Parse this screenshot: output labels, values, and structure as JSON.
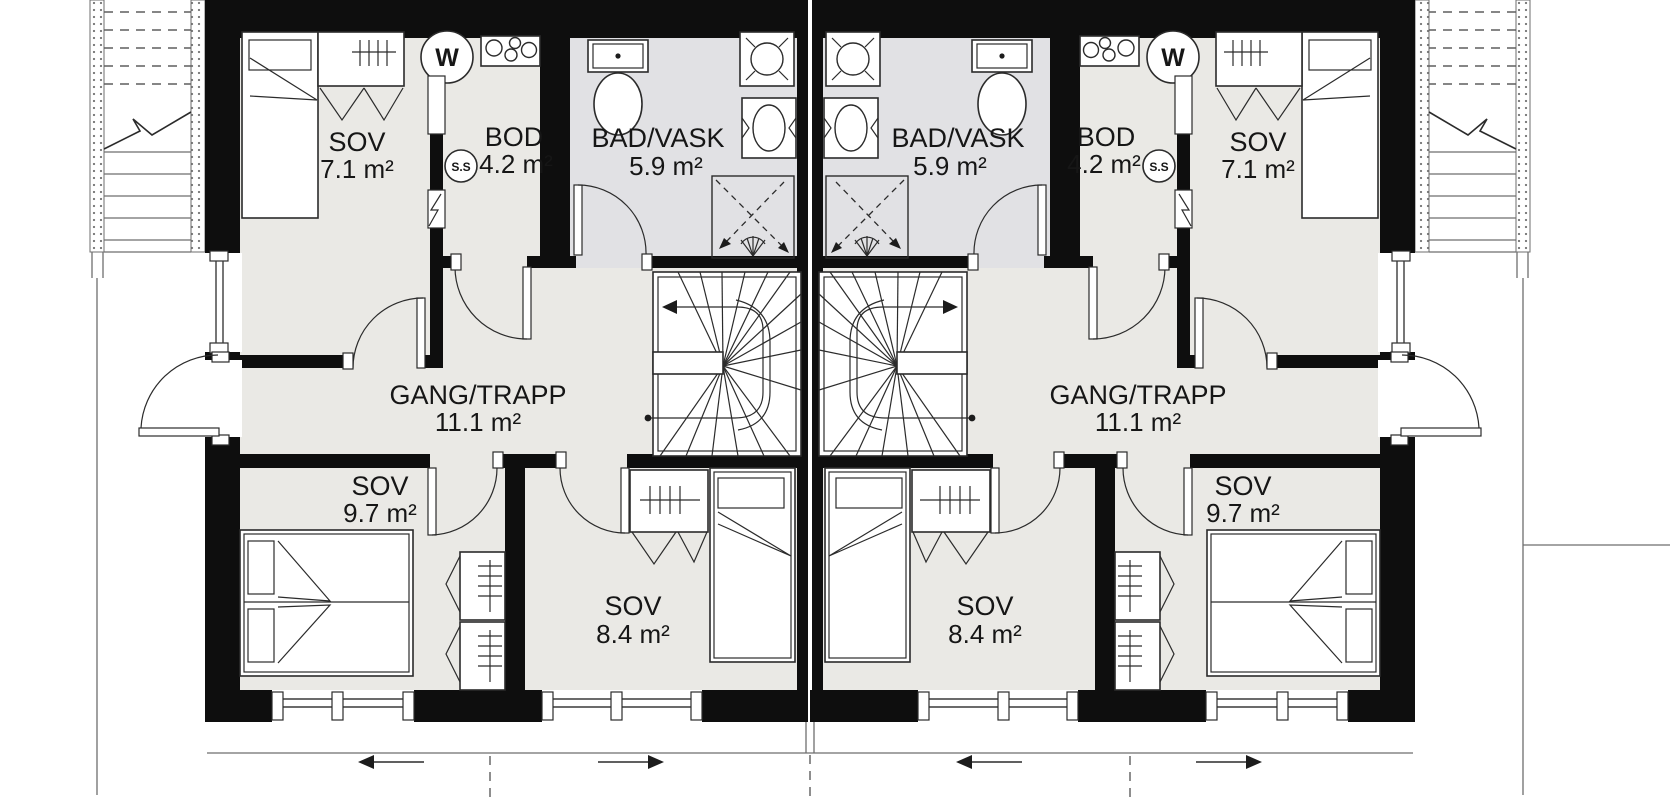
{
  "floorplan": {
    "colors": {
      "wall": "#0e0e0e",
      "room_floor": "#eae9e5",
      "bath_floor": "#e1e1e4",
      "line": "#2b2b2b",
      "background": "#ffffff"
    },
    "units": [
      {
        "side": "left",
        "rooms": [
          {
            "name": "SOV",
            "area": "7.1 m²"
          },
          {
            "name": "BOD",
            "area": "4.2 m²"
          },
          {
            "name": "BAD/VASK",
            "area": "5.9 m²"
          },
          {
            "name": "GANG/TRAPP",
            "area": "11.1 m²"
          },
          {
            "name": "SOV",
            "area": "9.7 m²"
          },
          {
            "name": "SOV",
            "area": "8.4 m²"
          }
        ],
        "icons": {
          "water_heater_label": "W",
          "fuse_box_label": "S.S"
        }
      },
      {
        "side": "right",
        "rooms": [
          {
            "name": "SOV",
            "area": "7.1 m²"
          },
          {
            "name": "BOD",
            "area": "4.2 m²"
          },
          {
            "name": "BAD/VASK",
            "area": "5.9 m²"
          },
          {
            "name": "GANG/TRAPP",
            "area": "11.1 m²"
          },
          {
            "name": "SOV",
            "area": "9.7 m²"
          },
          {
            "name": "SOV",
            "area": "8.4 m²"
          }
        ],
        "icons": {
          "water_heater_label": "W",
          "fuse_box_label": "S.S"
        }
      }
    ]
  }
}
